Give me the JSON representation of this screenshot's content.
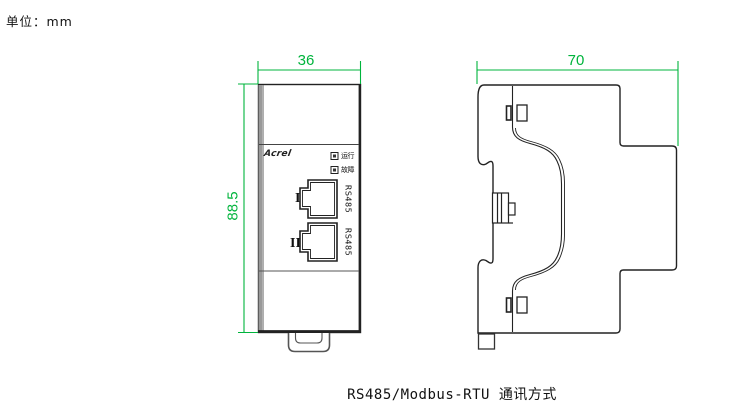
{
  "meta": {
    "unit_label": "单位：mm"
  },
  "caption": "RS485/Modbus-RTU 通讯方式",
  "colors": {
    "dimension_green": "#00b43c",
    "outline_black": "#1a1a1a",
    "edge_gray": "#999999",
    "background": "#ffffff"
  },
  "front_view": {
    "name": "front-view",
    "width_dim": "36",
    "height_dim": "88.5",
    "logo": "Acrel",
    "leds": [
      {
        "label": "运行"
      },
      {
        "label": "故障"
      }
    ],
    "ports": [
      {
        "number": "I",
        "bus": "RS485"
      },
      {
        "number": "II",
        "bus": "RS485"
      }
    ]
  },
  "side_view": {
    "name": "side-view",
    "depth_dim": "70"
  }
}
